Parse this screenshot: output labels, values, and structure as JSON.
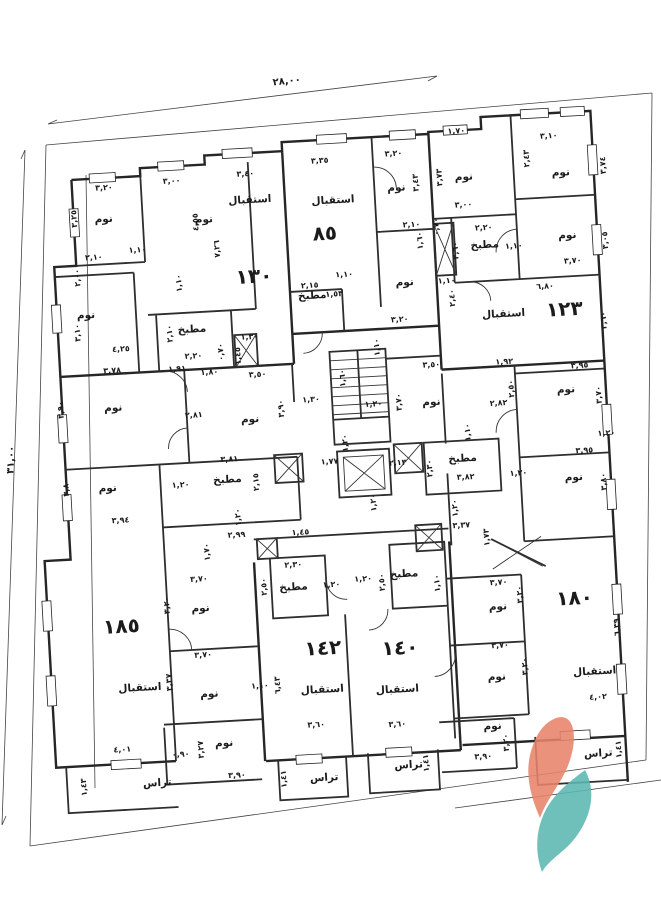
{
  "plan": {
    "overall_dimensions": {
      "top": "٢٨,٠٠",
      "left": "٣١,٠٠"
    },
    "apartment_numbers": [
      {
        "text": "١٣٠",
        "x": 265,
        "y": 279
      },
      {
        "text": "٨٥",
        "x": 338,
        "y": 240,
        "size": 22
      },
      {
        "text": "١٢٣",
        "x": 573,
        "y": 329
      },
      {
        "text": "١٨٥",
        "x": 113,
        "y": 621
      },
      {
        "text": "١٤٢",
        "x": 313,
        "y": 654
      },
      {
        "text": "١٤٠",
        "x": 390,
        "y": 658
      },
      {
        "text": "١٨٠",
        "x": 567,
        "y": 618
      }
    ],
    "room_labels": [
      {
        "text": "نوم",
        "x": 118,
        "y": 210
      },
      {
        "text": "نوم",
        "x": 218,
        "y": 216
      },
      {
        "text": "نوم",
        "x": 95,
        "y": 305
      },
      {
        "text": "نوم",
        "x": 412,
        "y": 195
      },
      {
        "text": "نوم",
        "x": 415,
        "y": 290
      },
      {
        "text": "نوم",
        "x": 480,
        "y": 188
      },
      {
        "text": "نوم",
        "x": 577,
        "y": 189
      },
      {
        "text": "نوم",
        "x": 580,
        "y": 252
      },
      {
        "text": "نوم",
        "x": 117,
        "y": 399
      },
      {
        "text": "نوم",
        "x": 253,
        "y": 418
      },
      {
        "text": "نوم",
        "x": 435,
        "y": 411
      },
      {
        "text": "نوم",
        "x": 570,
        "y": 406
      },
      {
        "text": "نوم",
        "x": 573,
        "y": 494
      },
      {
        "text": "نوم",
        "x": 107,
        "y": 479
      },
      {
        "text": "نوم",
        "x": 193,
        "y": 604
      },
      {
        "text": "نوم",
        "x": 197,
        "y": 690
      },
      {
        "text": "نوم",
        "x": 209,
        "y": 740
      },
      {
        "text": "نوم",
        "x": 490,
        "y": 619
      },
      {
        "text": "نوم",
        "x": 485,
        "y": 689
      },
      {
        "text": "نوم",
        "x": 478,
        "y": 738
      },
      {
        "text": "مطبخ",
        "x": 200,
        "y": 325
      },
      {
        "text": "مطبخ",
        "x": 322,
        "y": 298
      },
      {
        "text": "مطبخ",
        "x": 497,
        "y": 257
      },
      {
        "text": "مطبخ",
        "x": 227,
        "y": 477
      },
      {
        "text": "مطبخ",
        "x": 463,
        "y": 469
      },
      {
        "text": "مطبخ",
        "x": 287,
        "y": 588
      },
      {
        "text": "مطبخ",
        "x": 398,
        "y": 581
      },
      {
        "text": "استقبال",
        "x": 265,
        "y": 199
      },
      {
        "text": "استقبال",
        "x": 348,
        "y": 204
      },
      {
        "text": "استقبال",
        "x": 512,
        "y": 327
      },
      {
        "text": "استقبال",
        "x": 128,
        "y": 680
      },
      {
        "text": "استقبال",
        "x": 310,
        "y": 692
      },
      {
        "text": "استقبال",
        "x": 385,
        "y": 696
      },
      {
        "text": "استقبال",
        "x": 583,
        "y": 689
      },
      {
        "text": "تراس",
        "x": 140,
        "y": 776
      },
      {
        "text": "تراس",
        "x": 307,
        "y": 780
      },
      {
        "text": "تراس",
        "x": 392,
        "y": 772
      },
      {
        "text": "تراس",
        "x": 582,
        "y": 771
      }
    ],
    "dimension_labels": [
      {
        "text": "٣,٢٠",
        "x": 120,
        "y": 178
      },
      {
        "text": "٣,٠٠",
        "x": 188,
        "y": 175
      },
      {
        "text": "٣,٤٠",
        "x": 262,
        "y": 172
      },
      {
        "text": "٤,٥٥",
        "x": 212,
        "y": 215,
        "r": -90
      },
      {
        "text": "٧,٢٦",
        "x": 232,
        "y": 243,
        "r": -90
      },
      {
        "text": "٣,٢٥",
        "x": 91,
        "y": 205,
        "r": -90
      },
      {
        "text": "٢,١٠",
        "x": 106,
        "y": 247
      },
      {
        "text": "٢,٠٠",
        "x": 91,
        "y": 264,
        "r": -90
      },
      {
        "text": "٣,١٠",
        "x": 88,
        "y": 319,
        "r": -90
      },
      {
        "text": "٤,٢٥",
        "x": 128,
        "y": 340
      },
      {
        "text": "٢,١٠",
        "x": 180,
        "y": 325,
        "r": -90
      },
      {
        "text": "٢,٢٠",
        "x": 200,
        "y": 351
      },
      {
        "text": "١,٣٠",
        "x": 257,
        "y": 335
      },
      {
        "text": "١,٤٥",
        "x": 247,
        "y": 351,
        "r": -90
      },
      {
        "text": "١,١٠",
        "x": 150,
        "y": 242
      },
      {
        "text": "١,١٠",
        "x": 192,
        "y": 275,
        "r": -90
      },
      {
        "text": "٣,٣٥",
        "x": 337,
        "y": 163
      },
      {
        "text": "٣,٢٠",
        "x": 411,
        "y": 160
      },
      {
        "text": "٣,٤٣",
        "x": 434,
        "y": 188,
        "r": -90
      },
      {
        "text": "٣,٧٣",
        "x": 458,
        "y": 184,
        "r": -90
      },
      {
        "text": "٢,١٠",
        "x": 425,
        "y": 232
      },
      {
        "text": "١,٦٠",
        "x": 435,
        "y": 246,
        "r": -90
      },
      {
        "text": "٢,١٥",
        "x": 320,
        "y": 287
      },
      {
        "text": "١,١٠",
        "x": 355,
        "y": 278
      },
      {
        "text": "١,٥٣",
        "x": 344,
        "y": 297
      },
      {
        "text": "٣,٢٠",
        "x": 408,
        "y": 326
      },
      {
        "text": "٢,٤٠",
        "x": 464,
        "y": 305,
        "r": -90
      },
      {
        "text": "٢,٦٠",
        "x": 470,
        "y": 258,
        "r": -90
      },
      {
        "text": "٠,٧٠",
        "x": 452,
        "y": 233,
        "r": -90
      },
      {
        "text": "١,٧٠",
        "x": 475,
        "y": 141
      },
      {
        "text": "٣,١٠",
        "x": 567,
        "y": 151
      },
      {
        "text": "٣,٧٤",
        "x": 622,
        "y": 181,
        "r": -90
      },
      {
        "text": "٢,٤٣",
        "x": 546,
        "y": 170,
        "r": -90
      },
      {
        "text": "٣,٠٠",
        "x": 478,
        "y": 215
      },
      {
        "text": "٢,٢٠",
        "x": 497,
        "y": 239
      },
      {
        "text": "١,١٠",
        "x": 526,
        "y": 259
      },
      {
        "text": "٣,٠٥",
        "x": 620,
        "y": 256,
        "r": -90
      },
      {
        "text": "٣,٧٠",
        "x": 584,
        "y": 277
      },
      {
        "text": "٦,٨٠",
        "x": 555,
        "y": 301
      },
      {
        "text": "٣,٦٠",
        "x": 614,
        "y": 336,
        "r": -90
      },
      {
        "text": "١,١٠",
        "x": 457,
        "y": 290
      },
      {
        "text": "٣,٧٨",
        "x": 118,
        "y": 361
      },
      {
        "text": "١,٩١",
        "x": 183,
        "y": 363
      },
      {
        "text": "١,٨٠",
        "x": 215,
        "y": 368
      },
      {
        "text": "٣,٥٠",
        "x": 263,
        "y": 373
      },
      {
        "text": "٣,٩٠",
        "x": 67,
        "y": 395,
        "r": -90
      },
      {
        "text": "٣,٩٠",
        "x": 287,
        "y": 406,
        "r": -90
      },
      {
        "text": "٢,٨١",
        "x": 197,
        "y": 410
      },
      {
        "text": "٣,٨١",
        "x": 230,
        "y": 456
      },
      {
        "text": "٢,١٥",
        "x": 258,
        "y": 478,
        "r": -90
      },
      {
        "text": "٣,٨٠",
        "x": 68,
        "y": 473,
        "r": -90
      },
      {
        "text": "٣,٩٤",
        "x": 118,
        "y": 511
      },
      {
        "text": "١,٢٠",
        "x": 180,
        "y": 479
      },
      {
        "text": "١,٢٠",
        "x": 238,
        "y": 512,
        "r": -90
      },
      {
        "text": "٣,٥٠",
        "x": 437,
        "y": 373
      },
      {
        "text": "١,٣٠",
        "x": 315,
        "y": 401
      },
      {
        "text": "١,٢٠",
        "x": 377,
        "y": 409
      },
      {
        "text": "١,٦٠",
        "x": 350,
        "y": 379,
        "r": -90
      },
      {
        "text": "١,٢٠",
        "x": 349,
        "y": 444,
        "r": -90
      },
      {
        "text": "١,١٠",
        "x": 386,
        "y": 350,
        "r": -90
      },
      {
        "text": "٣,٧٠",
        "x": 405,
        "y": 406,
        "r": -90
      },
      {
        "text": "١,٩٢",
        "x": 510,
        "y": 374
      },
      {
        "text": "٢,٨٢",
        "x": 502,
        "y": 415
      },
      {
        "text": "١,١٠",
        "x": 472,
        "y": 440,
        "r": -90
      },
      {
        "text": "٢,١٣",
        "x": 398,
        "y": 469
      },
      {
        "text": "١,٧٧",
        "x": 330,
        "y": 464
      },
      {
        "text": "٢,٣٠",
        "x": 432,
        "y": 474,
        "r": -90
      },
      {
        "text": "٣,٨٢",
        "x": 465,
        "y": 487
      },
      {
        "text": "١,٢٠",
        "x": 374,
        "y": 505,
        "r": -90
      },
      {
        "text": "١,٢٠",
        "x": 455,
        "y": 515,
        "r": -90
      },
      {
        "text": "٣,٩٥",
        "x": 585,
        "y": 382
      },
      {
        "text": "٢,٥٠",
        "x": 518,
        "y": 399,
        "r": -90
      },
      {
        "text": "٣,٧٠",
        "x": 605,
        "y": 410,
        "r": -90
      },
      {
        "text": "١,٢٠",
        "x": 608,
        "y": 451
      },
      {
        "text": "٣,٩٥",
        "x": 585,
        "y": 467
      },
      {
        "text": "١,٢٠",
        "x": 518,
        "y": 486
      },
      {
        "text": "٣,٨٠",
        "x": 605,
        "y": 497,
        "r": -90
      },
      {
        "text": "٢,٩٩",
        "x": 233,
        "y": 532
      },
      {
        "text": "١,٧٠",
        "x": 205,
        "y": 545,
        "r": -90
      },
      {
        "text": "٣,٣٧",
        "x": 458,
        "y": 535
      },
      {
        "text": "١,٤٥",
        "x": 297,
        "y": 533
      },
      {
        "text": "١,٧٣",
        "x": 485,
        "y": 546,
        "r": -90
      },
      {
        "text": "٢,٣٠",
        "x": 288,
        "y": 565
      },
      {
        "text": "٢,٥٠",
        "x": 260,
        "y": 583,
        "r": -90
      },
      {
        "text": "١,٢٠",
        "x": 325,
        "y": 587
      },
      {
        "text": "١,٢٠",
        "x": 357,
        "y": 583
      },
      {
        "text": "٢,٥٠",
        "x": 378,
        "y": 585,
        "r": -90
      },
      {
        "text": "١,١٠",
        "x": 433,
        "y": 589,
        "r": -90
      },
      {
        "text": "٣,٧٠",
        "x": 492,
        "y": 594
      },
      {
        "text": "٣,٢٠",
        "x": 515,
        "y": 605,
        "r": -90
      },
      {
        "text": "٣,٧٠",
        "x": 490,
        "y": 657
      },
      {
        "text": "٣,٢٠",
        "x": 516,
        "y": 677,
        "r": -90
      },
      {
        "text": "٦,٣٩",
        "x": 610,
        "y": 643,
        "r": -90
      },
      {
        "text": "٤,٠٢",
        "x": 585,
        "y": 714
      },
      {
        "text": "٣,٦٠",
        "x": 302,
        "y": 726
      },
      {
        "text": "٣,٦٠",
        "x": 383,
        "y": 730
      },
      {
        "text": "٣,٩٠",
        "x": 467,
        "y": 767
      },
      {
        "text": "٣,٢٠",
        "x": 493,
        "y": 752,
        "r": -90
      },
      {
        "text": "٤,٠١",
        "x": 107,
        "y": 740
      },
      {
        "text": "٠,٩٠",
        "x": 165,
        "y": 748
      },
      {
        "text": "٣,٢٧",
        "x": 188,
        "y": 742,
        "r": -90
      },
      {
        "text": "٣,٩٠",
        "x": 220,
        "y": 772
      },
      {
        "text": "١,٤١",
        "x": 269,
        "y": 776,
        "r": -90
      },
      {
        "text": "١,٤٣",
        "x": 69,
        "y": 773,
        "r": -90
      },
      {
        "text": "١,٤١",
        "x": 412,
        "y": 768,
        "r": -90
      },
      {
        "text": "١,٤١",
        "x": 605,
        "y": 765,
        "r": -90
      },
      {
        "text": "٦,٤٣",
        "x": 268,
        "y": 682,
        "r": -90
      },
      {
        "text": "١,١٠",
        "x": 248,
        "y": 684
      },
      {
        "text": "٣,٢٠",
        "x": 162,
        "y": 596,
        "r": -90
      },
      {
        "text": "٣,٧٠",
        "x": 193,
        "y": 574
      },
      {
        "text": "٣,٧٠",
        "x": 193,
        "y": 650
      },
      {
        "text": "٣,٣٧",
        "x": 160,
        "y": 673,
        "r": -90
      },
      {
        "text": "٠,٧٠",
        "x": 230,
        "y": 346,
        "r": -90
      }
    ]
  },
  "colors": {
    "ink": "#1b1b1b",
    "wall": "#262626",
    "logo_orange": "#E8846B",
    "logo_teal": "#5CB8B2"
  }
}
